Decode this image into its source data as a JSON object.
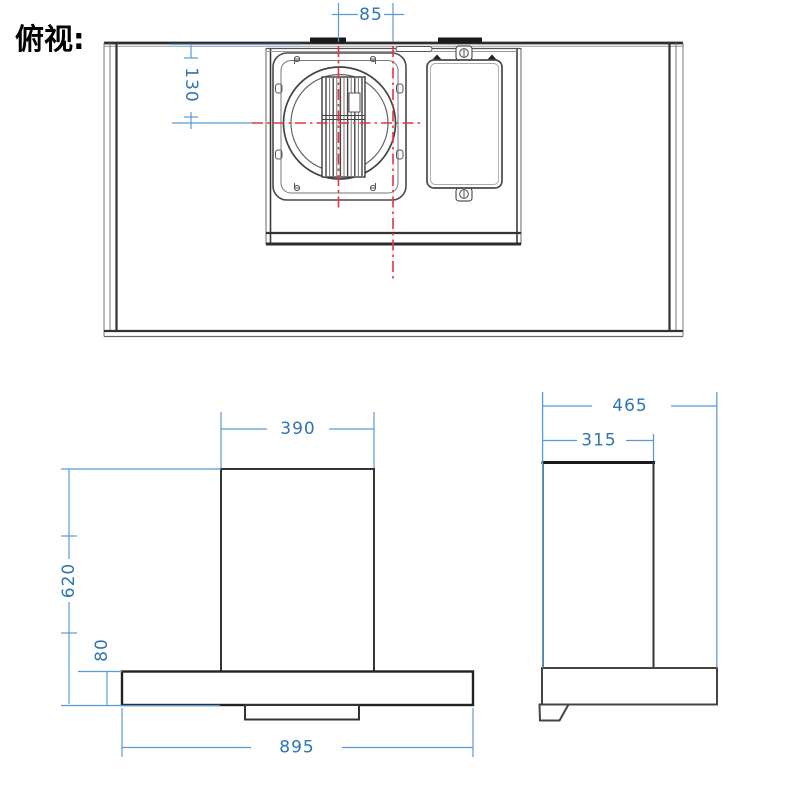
{
  "title": "俯视:",
  "colors": {
    "dimension_line": "#5b9bd5",
    "dimension_text": "#2e74b5",
    "centerline_red": "#e8333a",
    "outline_dark": "#2d2d2d",
    "outline_medium": "#4a4a4a",
    "outline_light": "#8a8a8a"
  },
  "top_view": {
    "dim_85": "85",
    "dim_130": "130"
  },
  "front_view": {
    "dim_390": "390",
    "dim_620": "620",
    "dim_80": "80",
    "dim_895": "895"
  },
  "side_view": {
    "dim_465": "465",
    "dim_315": "315"
  }
}
